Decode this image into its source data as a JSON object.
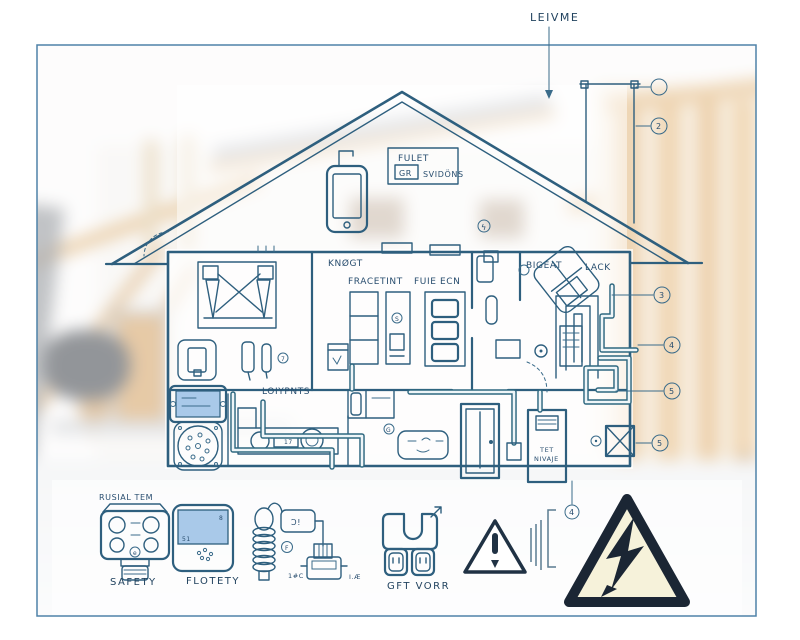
{
  "annotation": {
    "top_label": "LEIVME"
  },
  "attic": {
    "box_title": "FULET",
    "box_icon_tag": "GR",
    "box_subtitle": "SVIDÖNS"
  },
  "plan": {
    "room_labels": {
      "top_left": "KNØGT",
      "closet": "FRACETINT",
      "pantry": "FUIE ECN",
      "bedroom": "BIGEAT",
      "hall": "LACK",
      "kitchen": "LOIYPNTS"
    },
    "panel_line1": "TET",
    "panel_line2": "NIVAJE",
    "counter_tag": "17",
    "markers": {
      "lightning": "ϟ",
      "seven": "7",
      "g": "G",
      "s": "S"
    },
    "callouts": {
      "c1": "",
      "c2": "2",
      "c3": "3",
      "c4": "4",
      "c5": "5",
      "c6": "5",
      "c7": "4"
    }
  },
  "legend": {
    "safety": {
      "top_label": "RUSIAL TEM",
      "label": "SAFETY",
      "badge": "e"
    },
    "thermostat": {
      "label": "FLOTETY",
      "screen_left": "51",
      "screen_right": "8"
    },
    "heater": {
      "box_text": "Ɔ!",
      "circle_text": "F",
      "tag_left": "1#C",
      "tag_right": "I.Æ"
    },
    "outlet": {
      "label": "GFT VORR"
    }
  },
  "colors": {
    "blueprint": "#2e5f7e",
    "wire": "#2f6880",
    "screen": "#a9c9e9",
    "warning_fill": "#f6f2da",
    "warning_dark": "#1b2634"
  }
}
